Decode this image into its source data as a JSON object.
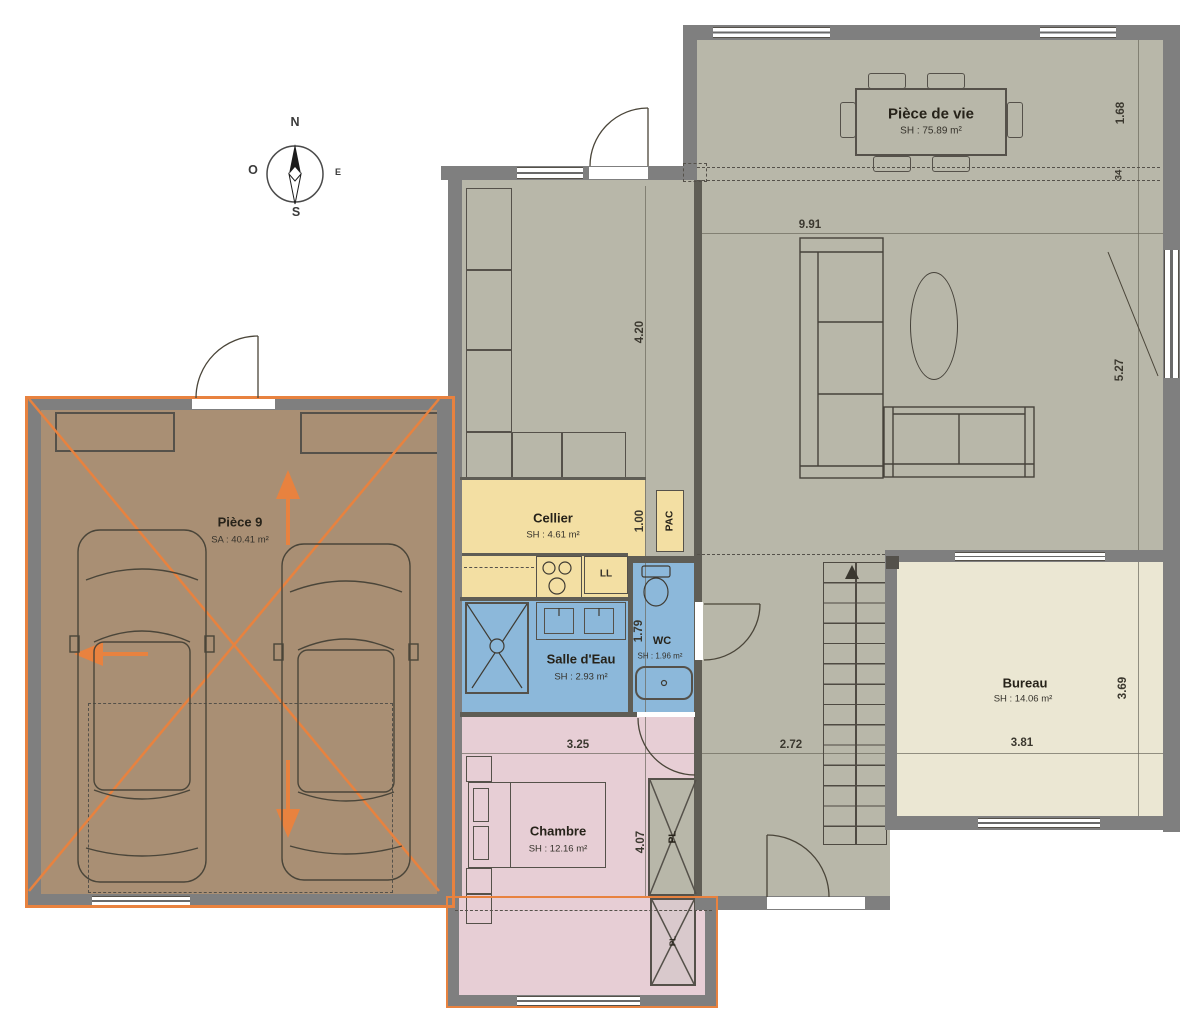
{
  "compass": {
    "n": "N",
    "s": "S",
    "o": "O",
    "e": "E"
  },
  "rooms": {
    "piece_de_vie": {
      "name": "Pièce de vie",
      "area": "SH : 75.89 m²"
    },
    "cellier": {
      "name": "Cellier",
      "area": "SH : 4.61 m²"
    },
    "salle_eau": {
      "name": "Salle d'Eau",
      "area": "SH : 2.93 m²"
    },
    "wc": {
      "name": "WC",
      "area": "SH : 1.96 m²"
    },
    "chambre": {
      "name": "Chambre",
      "area": "SH : 12.16 m²"
    },
    "bureau": {
      "name": "Bureau",
      "area": "SH : 14.06 m²"
    },
    "piece9": {
      "name": "Pièce 9",
      "area": "SA : 40.41 m²"
    }
  },
  "equipment": {
    "pac": "PAC",
    "lave_linge": "LL",
    "placard": "PL",
    "placard2": "PL"
  },
  "dimensions": {
    "d_168": "1.68",
    "d_34": "34",
    "d_991": "9.91",
    "d_420": "4.20",
    "d_100": "1.00",
    "d_179": "1.79",
    "d_527": "5.27",
    "d_325": "3.25",
    "d_272": "2.72",
    "d_381": "3.81",
    "d_369": "3.69",
    "d_407": "4.07"
  },
  "colors": {
    "wall": "#7f7f7f",
    "floor_main": "#b8b7a9",
    "garage": "#a98f74",
    "cellier": "#f3dfa3",
    "bathroom": "#8cb8da",
    "bedroom": "#e7ced5",
    "bureau": "#ebe7d3",
    "accent_orange": "#e8823f"
  }
}
